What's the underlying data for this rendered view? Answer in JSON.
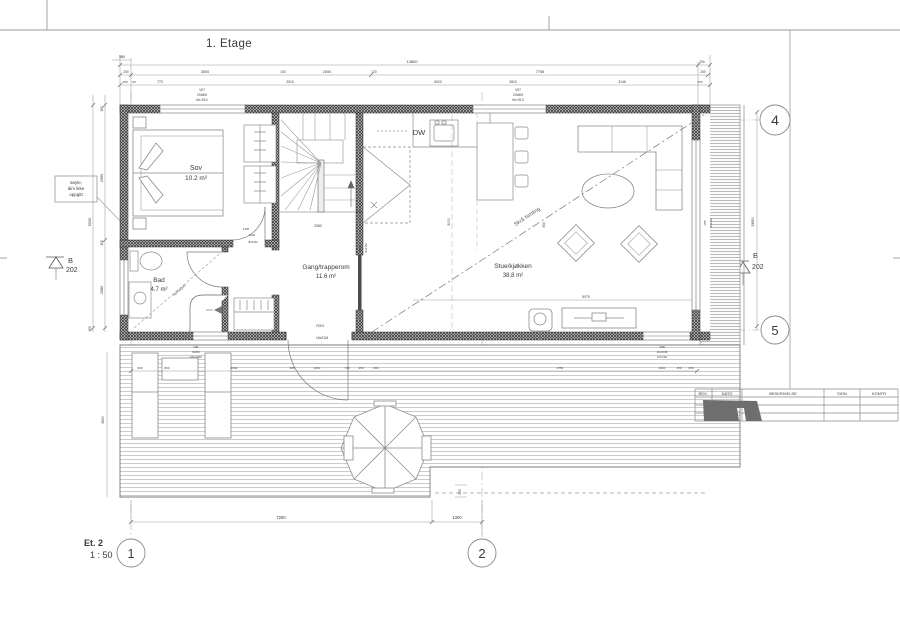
{
  "sheet": {
    "title": "1. Etage",
    "scale_label": "Et. 2",
    "scale_value": "1 : 50",
    "note_box": {
      "line1": "søyle,",
      "line2": "dim ikke",
      "line3": "oppgitt"
    },
    "revision_table": {
      "headers": [
        "REV.",
        "DATO",
        "BESKRIVELSE",
        "SIGN",
        "KONTR"
      ]
    }
  },
  "grid": {
    "bubble_1": "1",
    "bubble_2": "2",
    "bubble_4": "4",
    "bubble_5": "5",
    "section_letter": "B",
    "section_number": "202"
  },
  "rooms": {
    "bedroom": {
      "name": "Sov",
      "area": "10.2 m²"
    },
    "bath": {
      "name": "Bad",
      "area": "4.7 m²"
    },
    "hall": {
      "name": "Gang/trapperom",
      "area": "11.6 m²"
    },
    "living": {
      "name": "Stue/kjøkken",
      "area": "38.8 m²"
    },
    "dishwasher": "DW",
    "sloped_ceiling": "Skrå himling",
    "bath_note": "varmegulv"
  },
  "tags": {
    "v07_left": [
      "V07",
      "20x6M",
      "bh=910"
    ],
    "v07_right": [
      "V07",
      "20x6M",
      "bh=913"
    ],
    "v01": [
      "V01",
      "8x6M",
      "bh=1200"
    ],
    "v08": [
      "V08",
      "10x21M",
      "bh=110"
    ],
    "v05": [
      "V05",
      "8x21M"
    ],
    "yd01": [
      "YD01",
      "16x21M"
    ]
  },
  "dims": {
    "t0": "380",
    "t1": [
      "13800",
      "250"
    ],
    "t2": [
      "250",
      "3500",
      "100",
      "2000",
      "120",
      "7756",
      "250"
    ],
    "t3": [
      "250",
      "50",
      "770",
      "2010",
      "6020",
      "2810",
      "3146",
      "200"
    ],
    "left": [
      "100",
      "2950",
      "100",
      "2080",
      "5000",
      "150"
    ],
    "right": "5850",
    "living": [
      "5075",
      "3000",
      "900"
    ],
    "stair": "2080",
    "bedroom_door": [
      "1100",
      "ID01",
      "8x21M"
    ],
    "living_door": [
      "ID03",
      "8x21M"
    ],
    "bottom": [
      "7250",
      "1300"
    ],
    "deck_step": "250",
    "deck_left": "3650",
    "deck_row": [
      "600",
      "800",
      "2040",
      "395",
      "1010",
      "740",
      "250",
      "600",
      "3750",
      "1010",
      "150",
      "250"
    ]
  },
  "colors": {
    "wall_hatch": "#3c3c3c",
    "line": "#3a3a3a",
    "dim": "#9a9a9a",
    "deck_line": "#a8a8a8",
    "stamp": "#6e6e6e"
  }
}
